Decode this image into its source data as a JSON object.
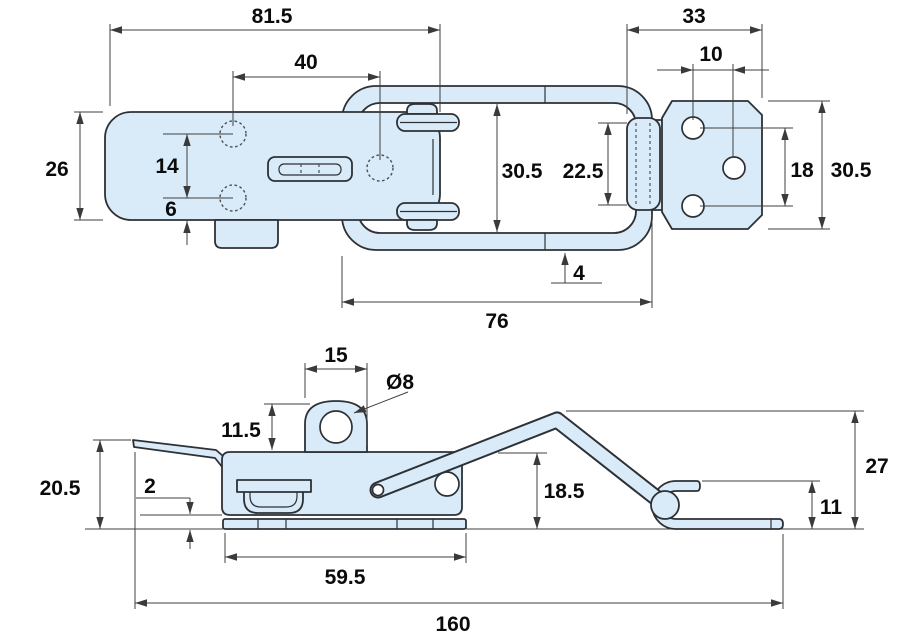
{
  "colors": {
    "background": "#ffffff",
    "part_fill": "#d9ebf8",
    "outline": "#2d3135",
    "dimension_line": "#3f3f3f",
    "text": "#0b0b0b"
  },
  "dimensions": {
    "top_view": {
      "overall_width": "81.5",
      "hole_pitch": "40",
      "plate_height": "26",
      "hole_spacing": "14",
      "hole_to_edge": "6",
      "catch_section_width": "33",
      "catch_hole_pitch": "10",
      "loop_inner_width": "30.5",
      "hook_length": "22.5",
      "wire_thickness": "4",
      "loop_length": "76",
      "catch_hole_vertical_pitch": "18",
      "catch_plate_height": "30.5"
    },
    "side_view": {
      "lug_width": "15",
      "lug_hole_diameter": "Ø8",
      "lug_height": "11.5",
      "front_height": "20.5",
      "plate_thickness": "2",
      "body_height": "18.5",
      "lever_peak_height": "27",
      "hook_lip_height": "11",
      "base_length": "59.5",
      "overall_length": "160"
    }
  }
}
